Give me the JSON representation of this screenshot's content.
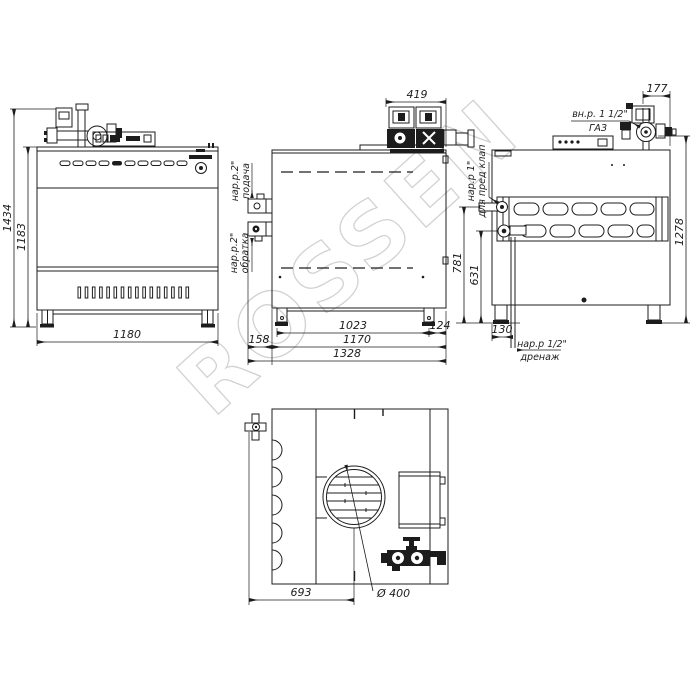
{
  "watermark": "ROSSEN",
  "front_view": {
    "dim_total_height": "1434",
    "dim_body_height": "1183",
    "dim_width": "1180"
  },
  "side_view": {
    "dim_pump_assembly": "419",
    "supply_thread": "нар.р.2\"",
    "supply_label": "подача",
    "return_thread": "нар.р.2\"",
    "return_label": "обратка",
    "dim_leg_span": "1023",
    "dim_rear_overhang": "124",
    "dim_body_depth": "1170",
    "dim_front_overhang": "158",
    "dim_total_depth": "1328"
  },
  "back_view": {
    "dim_gas_offset": "177",
    "gas_thread": "вн.р. 1 1/2\"",
    "gas_label": "ГАЗ",
    "safety_thread": "нар.р 1\"",
    "safety_label": "для пред клап",
    "dim_safety_height": "781",
    "dim_return_height": "631",
    "dim_total_height": "1278",
    "dim_drain_offset": "130",
    "drain_thread": "нар.р 1/2\"",
    "drain_label": "дренаж"
  },
  "bottom_view": {
    "dim_flue_center_offset": "693",
    "dim_flue_diameter": "Ø 400"
  },
  "colors": {
    "line": "#1c1c1c",
    "watermark": "#d2d2d2",
    "background": "#ffffff"
  }
}
